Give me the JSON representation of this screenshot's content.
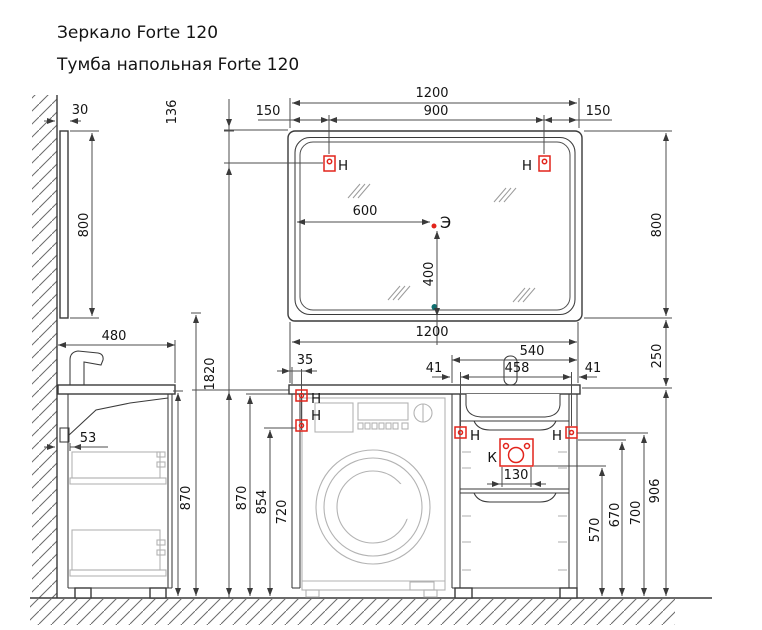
{
  "titles": {
    "mirror": "Зеркало Forte 120",
    "cabinet": "Тумба напольная Forte 120"
  },
  "markers": {
    "hook": "Н",
    "electric": "Э",
    "drain": "К"
  },
  "dims": {
    "mirror_width": "1200",
    "hook_span": "900",
    "hook_left": "150",
    "hook_right": "150",
    "hook_drop": "136",
    "mirror_depth": "30",
    "mirror_height": "800",
    "mirror_height_r": "800",
    "center_x": "600",
    "center_y": "400",
    "gap": "250",
    "total_height": "1820",
    "cab_width": "1200",
    "cab_depth": "480",
    "wall_gap": "53",
    "cab_height_side": "870",
    "cab_height": "870",
    "counter_under": "854",
    "hook_low": "720",
    "hook_offset": "35",
    "washbasin_w": "540",
    "drain_span": "458",
    "margin_l": "41",
    "margin_r": "41",
    "drain_w": "130",
    "drawer_top": "570",
    "apron": "670",
    "hook_front": "700",
    "counter_top": "906"
  },
  "colors": {
    "line": "#3a3a3a",
    "light_gray": "#b3b3b3",
    "red": "#e2241b",
    "teal": "#0f6f6f",
    "background": "#ffffff"
  }
}
